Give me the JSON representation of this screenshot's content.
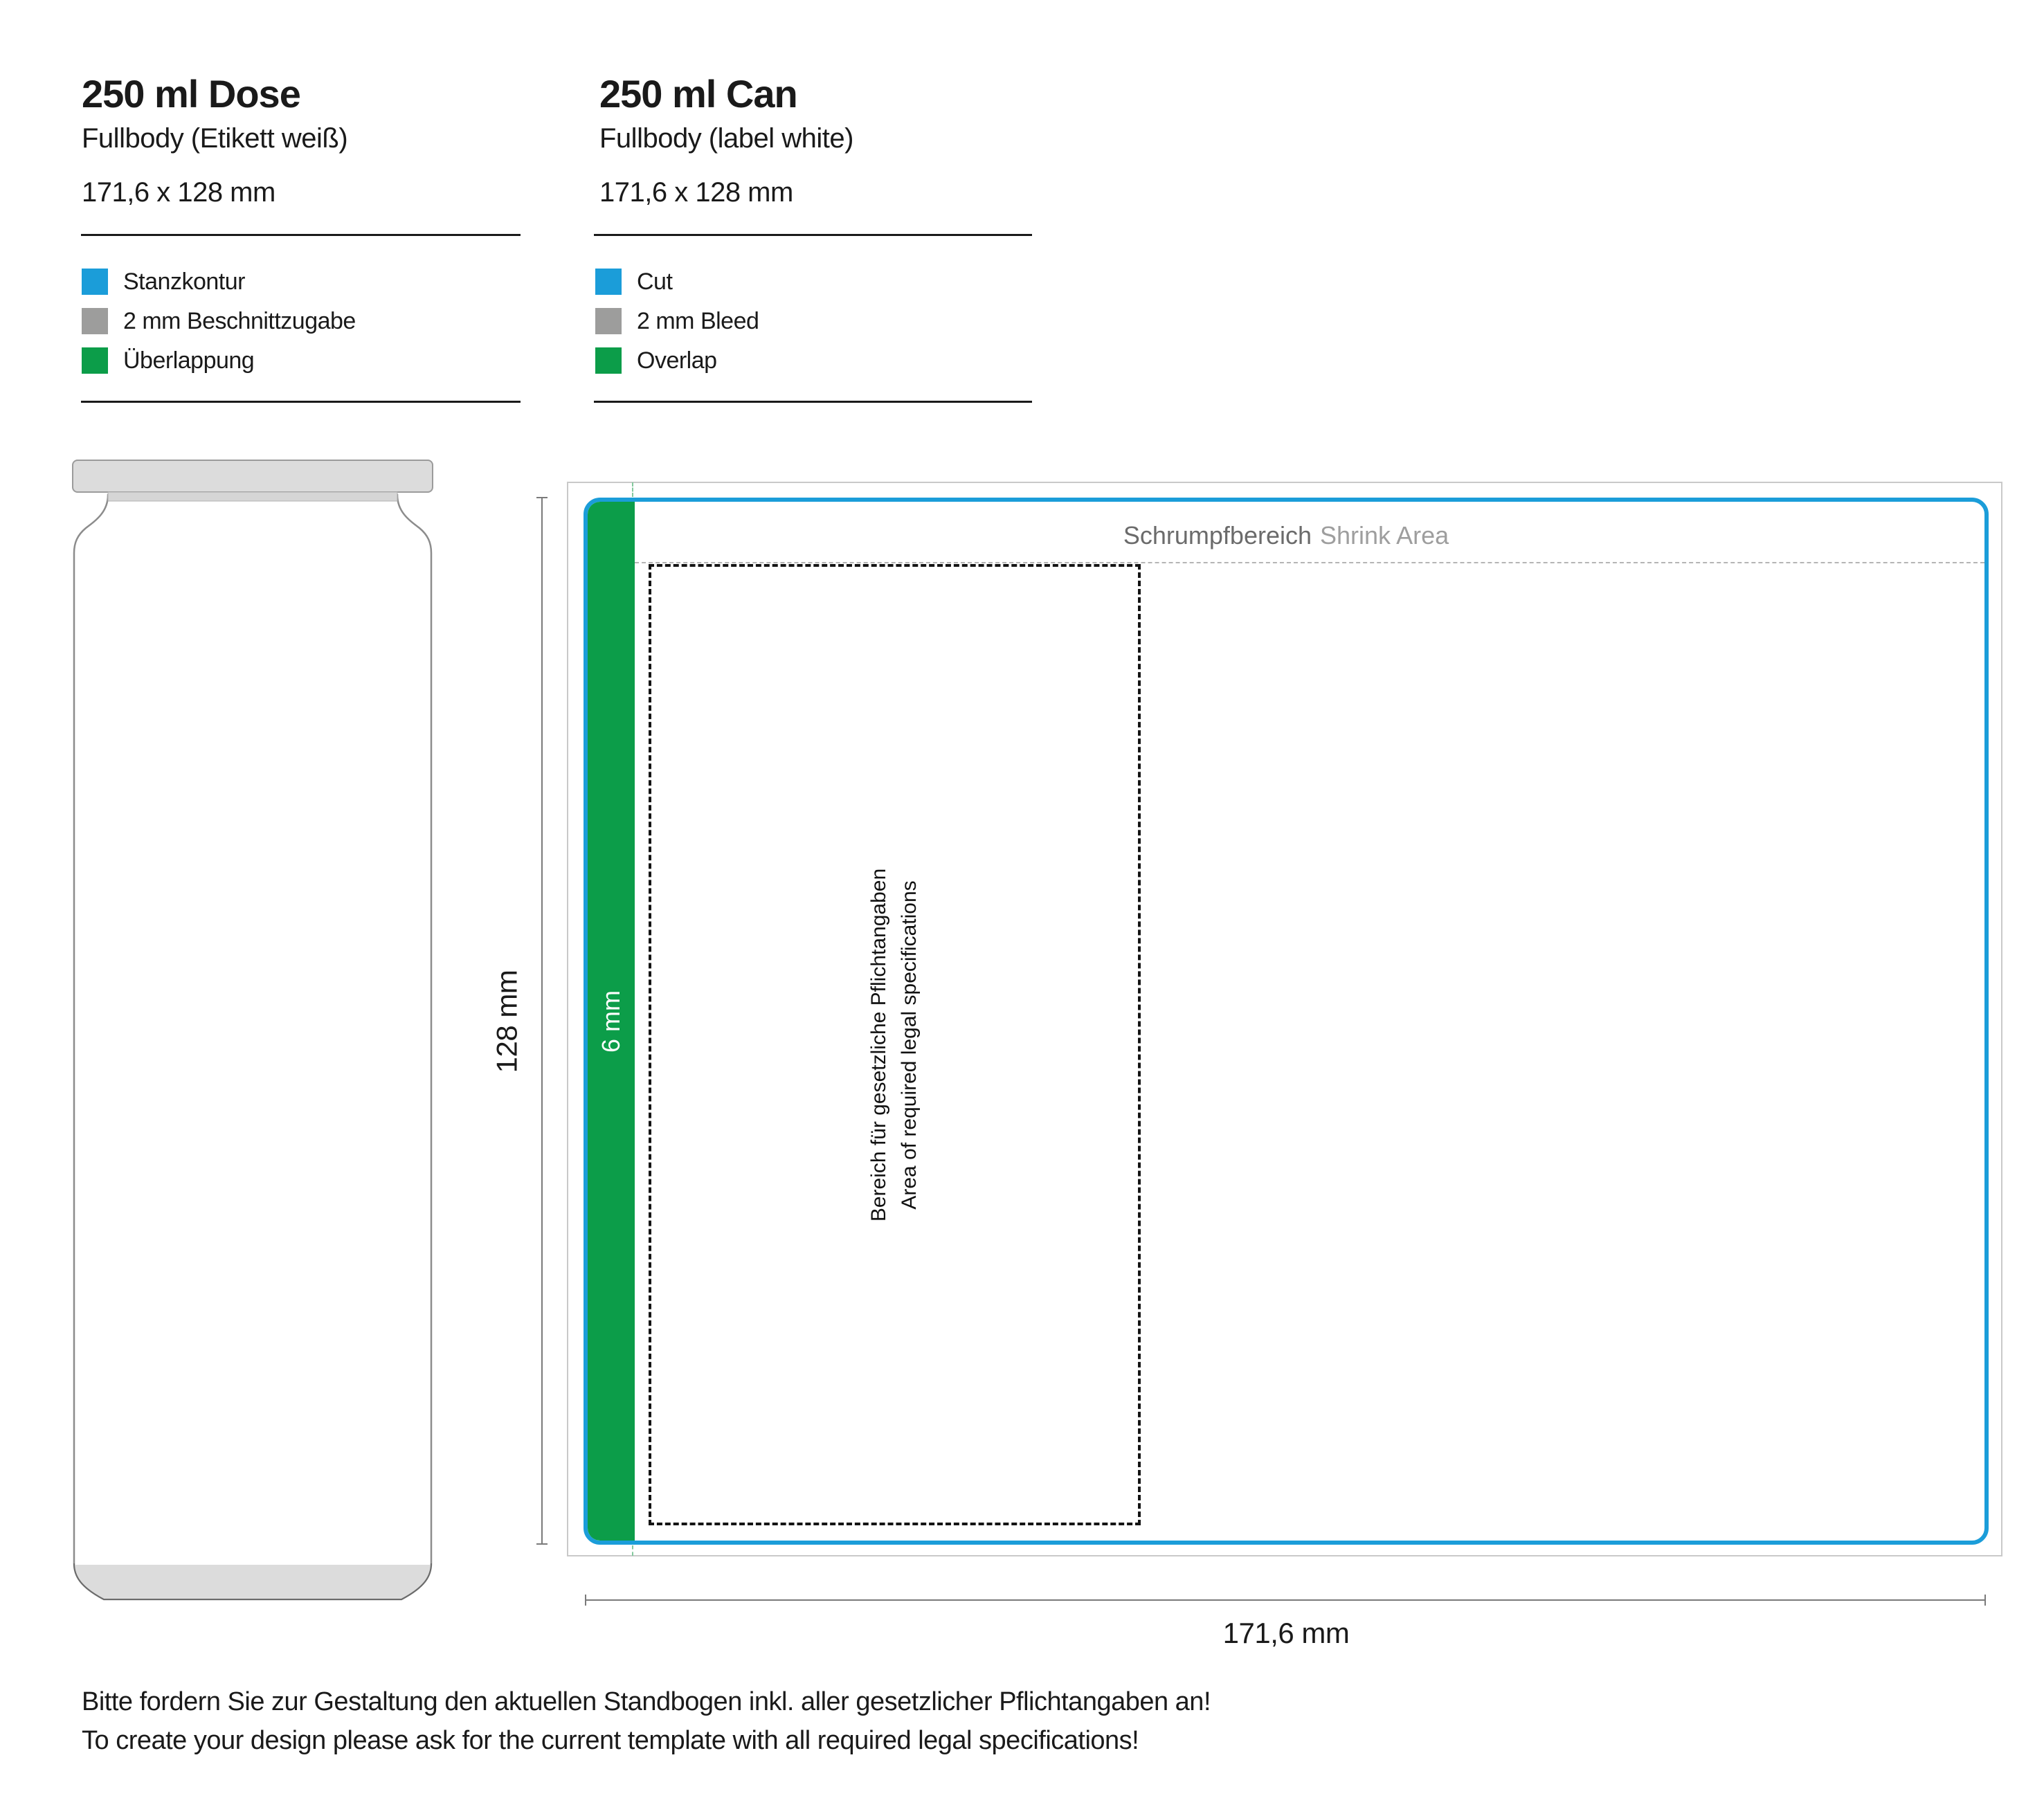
{
  "columns": [
    {
      "title": "250 ml Dose",
      "subtitle": "Fullbody (Etikett weiß)",
      "size": "171,6 x 128 mm",
      "legend": [
        {
          "label": "Stanzkontur",
          "color": "#1B9DD9"
        },
        {
          "label": "2 mm Beschnittzugabe",
          "color": "#9D9D9C"
        },
        {
          "label": "Überlappung",
          "color": "#0C9D49"
        }
      ]
    },
    {
      "title": "250 ml Can",
      "subtitle": "Fullbody (label white)",
      "size": "171,6 x 128 mm",
      "legend": [
        {
          "label": "Cut",
          "color": "#1B9DD9"
        },
        {
          "label": "2 mm Bleed",
          "color": "#9D9D9C"
        },
        {
          "label": "Overlap",
          "color": "#0C9D49"
        }
      ]
    }
  ],
  "template": {
    "shrink_label_de": "Schrumpfbereich",
    "shrink_label_en": "Shrink Area",
    "overlap_label": "6 mm",
    "legal_line_de": "Bereich für gesetzliche Pflichtangaben",
    "legal_line_en": "Area of required legal specifications",
    "height_label": "128 mm",
    "width_label": "171,6 mm"
  },
  "footer": {
    "line_de": "Bitte fordern Sie zur Gestaltung den aktuellen Standbogen inkl. aller gesetzlicher Pflichtangaben an!",
    "line_en": "To create your design please ask for the current template with all required legal specifications!"
  },
  "colors": {
    "cut": "#1B9DD9",
    "bleed": "#9D9D9C",
    "overlap": "#0C9D49"
  }
}
